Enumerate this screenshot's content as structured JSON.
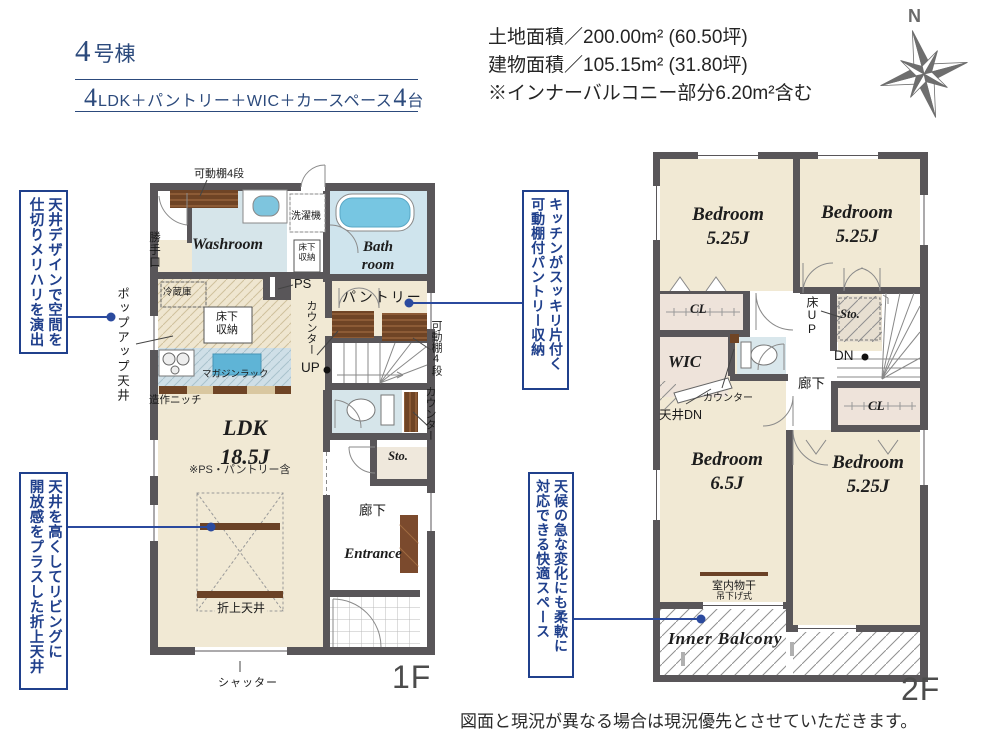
{
  "header": {
    "building_num": "4",
    "building_suffix": "号棟",
    "layout_n1": "4",
    "layout_t1": "LDK＋パントリー＋WIC＋カースペース",
    "layout_n2": "4",
    "layout_t2": "台",
    "land_area": "土地面積／200.00m² (60.50坪)",
    "building_area": "建物面積／105.15m² (31.80坪)",
    "area_note": "※インナーバルコニー部分6.20m²含む",
    "compass_n": "N"
  },
  "callouts": {
    "ceiling_design": "天井デザインで空間を\n仕切りメリハリを演出",
    "popup_ceiling": "ポップアップ天井",
    "pantry_shelf": "キッチンがスッキリ片付く\n可動棚付パントリー収納",
    "folded_ceiling": "天井を高くしてリビングに\n開放感をプラスした折上天井",
    "balcony_space": "天候の急な変化にも柔軟に\n対応できる快適スペース"
  },
  "floor1": {
    "floor_label": "1F",
    "washroom": "Washroom",
    "bathroom": "Bath\nroom",
    "ldk": "LDK\n18.5J",
    "ldk_note": "※PS・パントリー含",
    "pantry": "パントリー",
    "storage": "Sto.",
    "entrance": "Entrance",
    "hallway": "廊下",
    "shelf_top": "可動棚4段",
    "shelf_right": "可動棚4段",
    "back_door": "勝手口",
    "washer": "洗濯機",
    "floor_storage_a": "床下\n収納",
    "floor_storage_b": "床下\n収納",
    "fridge": "冷蔵庫",
    "ps": "PS",
    "counter_a": "カウンター",
    "counter_b": "カウンター",
    "up": "UP",
    "magazine_rack": "マガジンラック",
    "niche": "造作ニッチ",
    "folded_ceiling": "折上天井",
    "shutter": "シャッター"
  },
  "floor2": {
    "floor_label": "2F",
    "bedroom_a": "Bedroom\n5.25J",
    "bedroom_b": "Bedroom\n5.25J",
    "bedroom_c": "Bedroom\n6.5J",
    "bedroom_d": "Bedroom\n5.25J",
    "wic": "WIC",
    "cl_a": "CL",
    "cl_b": "CL",
    "storage": "Sto.",
    "hallway": "廊下",
    "floor_up": "床UP",
    "dn": "DN",
    "counter": "カウンター",
    "ceiling_dn": "天井DN",
    "drying": "室内物干",
    "drying_type": "吊下げ式",
    "inner_balcony": "Inner Balcony"
  },
  "footer": {
    "disclaimer": "図面と現況が異なる場合は現況優先とさせていただきます。"
  }
}
